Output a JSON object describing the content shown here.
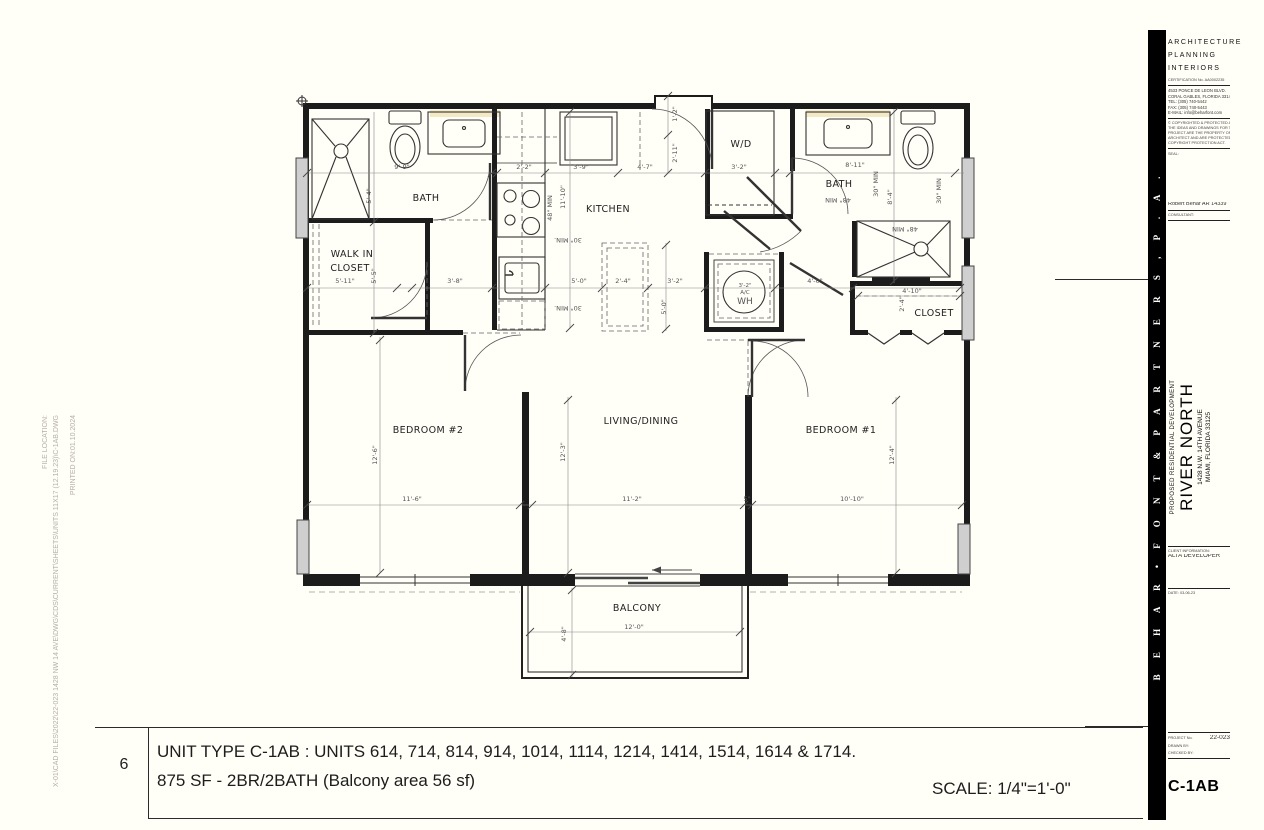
{
  "margin_notes": {
    "file_location_label": "FILE LOCATION:",
    "file_path": "X-01\\CAD FILES\\2022\\22-023 1428 NW 14 AVE\\DWG\\CDS\\CURRENT\\SHEETS\\UNITS 11X17 (12.19.23)\\C-1AB.DWG",
    "printed_on": "PRINTED ON:01.10.2024"
  },
  "title_bar": {
    "number": "6",
    "line1": "UNIT TYPE  C-1AB : UNITS 614, 714,  814, 914, 1014, 1114, 1214, 1414, 1514, 1614 & 1714.",
    "line2": "875 SF  - 2BR/2BATH (Balcony area 56 sf)",
    "scale": "SCALE: 1/4\"=1'-0\""
  },
  "sidebar": {
    "firm_vertical": "B E H A R  •  F O N T  &  P A R T N E R S ,   P . A .",
    "services": [
      "ARCHITECTURE",
      "PLANNING",
      "INTERIORS"
    ],
    "certification": "CERTIFICATION No. AA0002235",
    "address": [
      "4533 PONCE DE LEON BLVD.",
      "CORAL GABLES, FLORIDA 33146",
      "TEL: (305) 740-5442",
      "FAX: (305) 740-5443",
      "E-MAIL: info@beharfont.com"
    ],
    "disclaimer": [
      "© COPYRIGHTED & PROTECTED ALL",
      "THE IDEAS AND DRAWINGS FOR THIS",
      "PROJECT ARE THE PROPERTY OF THE",
      "ARCHITECT AND ARE PROTECTED UNDER THE",
      "COPYRIGHT PROTECTION ACT."
    ],
    "seal_label": "SEAL:",
    "architect": "Robert Behar  AR 14339",
    "consultant_label": "CONSULTANT:",
    "project_type": "PROPOSED RESIDENTIAL DEVELOPMENT",
    "project_name": "RIVER NORTH",
    "project_address1": "1428 N.W. 14TH AVENUE",
    "project_address2": "MIAMI, FLORIDA 33125",
    "client_label": "CLIENT INFORMATION:",
    "client": "ALTA DEVELOPER",
    "date": "DATE:  03-06-23",
    "project_no_label": "PROJECT No.",
    "project_no": "22-023",
    "drawn_by_label": "DRAWN BY:",
    "checked_by_label": "CHECKED BY:",
    "sheet_code": "C-1AB"
  },
  "plan": {
    "room_labels": [
      {
        "t": "BATH",
        "x": 426,
        "y": 201
      },
      {
        "t": "WALK IN",
        "x": 352,
        "y": 257
      },
      {
        "t": "CLOSET",
        "x": 350,
        "y": 271
      },
      {
        "t": "KITCHEN",
        "x": 608,
        "y": 212
      },
      {
        "t": "W/D",
        "x": 741,
        "y": 147
      },
      {
        "t": "BATH",
        "x": 839,
        "y": 187
      },
      {
        "t": "CLOSET",
        "x": 934,
        "y": 316
      },
      {
        "t": "BEDROOM #2",
        "x": 428,
        "y": 433
      },
      {
        "t": "LIVING/DINING",
        "x": 641,
        "y": 424
      },
      {
        "t": "BEDROOM #1",
        "x": 841,
        "y": 433
      },
      {
        "t": "BALCONY",
        "x": 637,
        "y": 611
      }
    ],
    "dims": [
      {
        "t": "9'-9\"",
        "x": 402,
        "y": 169
      },
      {
        "t": "5'-4\"",
        "x": 371,
        "y": 196,
        "r": -90
      },
      {
        "t": "2'-2\"",
        "x": 524,
        "y": 169
      },
      {
        "t": "3'-9\"",
        "x": 581,
        "y": 169
      },
      {
        "t": "4'-7\"",
        "x": 645,
        "y": 169
      },
      {
        "t": "1'-2\"",
        "x": 677,
        "y": 114,
        "r": -90
      },
      {
        "t": "2'-11\"",
        "x": 677,
        "y": 153,
        "r": -90
      },
      {
        "t": "3'-2\"",
        "x": 739,
        "y": 169
      },
      {
        "t": "8'-11\"",
        "x": 855,
        "y": 167
      },
      {
        "t": "11'-10\"",
        "x": 565,
        "y": 197,
        "r": -90
      },
      {
        "t": "48\" MIN",
        "x": 552,
        "y": 208,
        "r": -90
      },
      {
        "t": "48\" MIN",
        "x": 838,
        "y": 198,
        "r": 180
      },
      {
        "t": "30\" MIN",
        "x": 878,
        "y": 184,
        "r": -90
      },
      {
        "t": "8'-4\"",
        "x": 892,
        "y": 197,
        "r": -90
      },
      {
        "t": "30\" MIN",
        "x": 941,
        "y": 191,
        "r": -90
      },
      {
        "t": "48\" MIN",
        "x": 905,
        "y": 227,
        "r": 180
      },
      {
        "t": "5'-11\"",
        "x": 345,
        "y": 283
      },
      {
        "t": "5'-5\"",
        "x": 376,
        "y": 276,
        "r": -90
      },
      {
        "t": "3'-8\"",
        "x": 455,
        "y": 283
      },
      {
        "t": "30\" MIN.",
        "x": 568,
        "y": 238,
        "r": 180
      },
      {
        "t": "5'-0\"",
        "x": 579,
        "y": 283
      },
      {
        "t": "30\" MIN.",
        "x": 568,
        "y": 306,
        "r": 180
      },
      {
        "t": "2'-4\"",
        "x": 623,
        "y": 283
      },
      {
        "t": "3'-2\"",
        "x": 675,
        "y": 283
      },
      {
        "t": "5'-0\"",
        "x": 666,
        "y": 307,
        "r": -90
      },
      {
        "t": "4'-0\"",
        "x": 815,
        "y": 283
      },
      {
        "t": "4'-10\"",
        "x": 912,
        "y": 293
      },
      {
        "t": "2'-4\"",
        "x": 904,
        "y": 304,
        "r": -90
      },
      {
        "t": "12'-6\"",
        "x": 377,
        "y": 455,
        "r": -90
      },
      {
        "t": "11'-6\"",
        "x": 412,
        "y": 501
      },
      {
        "t": "12'-3\"",
        "x": 565,
        "y": 452,
        "r": -90
      },
      {
        "t": "11'-2\"",
        "x": 632,
        "y": 501
      },
      {
        "t": "5\"",
        "x": 747,
        "y": 501
      },
      {
        "t": "12'-4\"",
        "x": 894,
        "y": 455,
        "r": -90
      },
      {
        "t": "10'-10\"",
        "x": 852,
        "y": 501
      },
      {
        "t": "4'-8\"",
        "x": 566,
        "y": 634,
        "r": -90
      },
      {
        "t": "12'-0\"",
        "x": 634,
        "y": 629
      },
      {
        "t": "3'-2\"",
        "x": 745,
        "y": 287,
        "s": 5.5
      },
      {
        "t": "A/C",
        "x": 745,
        "y": 294,
        "s": 5.5
      },
      {
        "t": "WH",
        "x": 745,
        "y": 304,
        "s": 9
      }
    ],
    "ticks": [
      [
        307,
        173
      ],
      [
        492,
        173
      ],
      [
        497,
        173
      ],
      [
        545,
        173
      ],
      [
        618,
        173
      ],
      [
        668,
        173
      ],
      [
        705,
        173
      ],
      [
        775,
        173
      ],
      [
        790,
        173
      ],
      [
        955,
        173
      ],
      [
        307,
        288
      ],
      [
        397,
        288
      ],
      [
        412,
        288
      ],
      [
        492,
        288
      ],
      [
        545,
        288
      ],
      [
        602,
        288
      ],
      [
        648,
        288
      ],
      [
        705,
        288
      ],
      [
        775,
        288
      ],
      [
        853,
        288
      ],
      [
        960,
        288
      ],
      [
        858,
        296
      ],
      [
        960,
        296
      ],
      [
        307,
        505
      ],
      [
        520,
        505
      ],
      [
        532,
        505
      ],
      [
        744,
        505
      ],
      [
        752,
        505
      ],
      [
        962,
        505
      ],
      [
        530,
        632
      ],
      [
        740,
        632
      ],
      [
        374,
        222
      ],
      [
        374,
        333
      ],
      [
        380,
        340
      ],
      [
        380,
        573
      ],
      [
        568,
        400
      ],
      [
        568,
        573
      ],
      [
        570,
        112
      ],
      [
        570,
        328
      ],
      [
        666,
        245
      ],
      [
        666,
        329
      ],
      [
        668,
        96
      ],
      [
        668,
        135
      ],
      [
        894,
        112
      ],
      [
        894,
        281
      ],
      [
        896,
        400
      ],
      [
        896,
        573
      ],
      [
        572,
        590
      ],
      [
        572,
        675
      ]
    ]
  }
}
